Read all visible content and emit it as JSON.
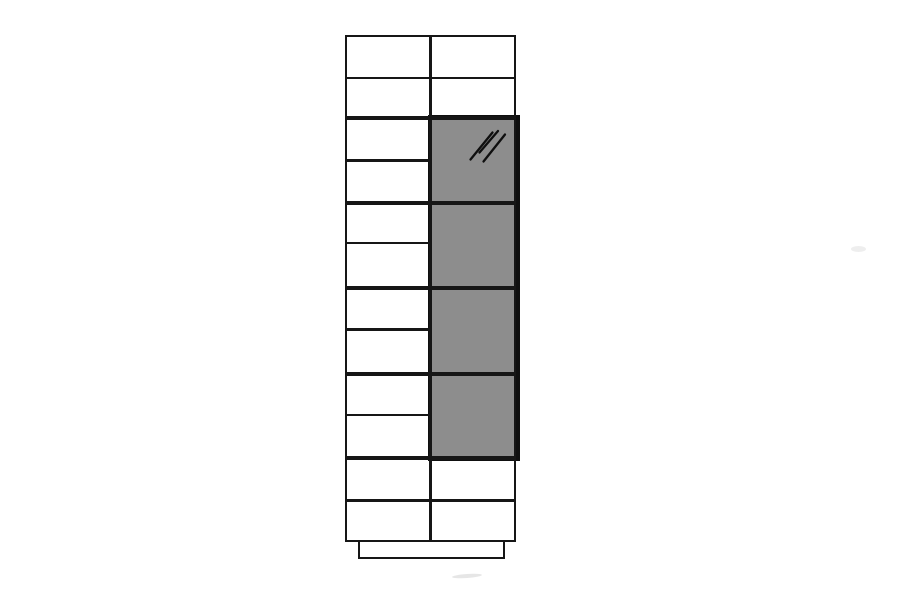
{
  "scene": {
    "width": 900,
    "height": 600,
    "background": "#ffffff",
    "kind": "furniture-technical-line-drawing"
  },
  "palette": {
    "line": "#161616",
    "glass_border": "#0f0f0f",
    "glass_fill": "#8d8d8d",
    "cabinet_fill": "#ffffff",
    "smudge": "#c8c8c8"
  },
  "cabinet": {
    "counts": {
      "left_drawer_rows": 12,
      "right_top_cells": 2,
      "glass_panes": 4,
      "right_bottom_cells": 2
    },
    "body": {
      "x": 345,
      "y": 35,
      "w": 171,
      "h": 507,
      "stroke": 2.6
    },
    "center_divider": {
      "x": 429.2,
      "y1": 35,
      "y2": 542,
      "w": 2.6
    },
    "h_lines": [
      {
        "y": 78,
        "x1": 345,
        "x2": 516,
        "w": 2.6,
        "kind": "thin-full"
      },
      {
        "y": 118,
        "x1": 345,
        "x2": 516,
        "w": 4,
        "kind": "thick-full"
      },
      {
        "y": 160.5,
        "x1": 345,
        "x2": 432,
        "w": 2.6,
        "kind": "thin-left"
      },
      {
        "y": 202.5,
        "x1": 345,
        "x2": 516,
        "w": 4,
        "kind": "thick-full"
      },
      {
        "y": 243,
        "x1": 345,
        "x2": 432,
        "w": 2.6,
        "kind": "thin-left"
      },
      {
        "y": 287.5,
        "x1": 345,
        "x2": 516,
        "w": 4,
        "kind": "thick-full"
      },
      {
        "y": 329.5,
        "x1": 345,
        "x2": 432,
        "w": 2.6,
        "kind": "thin-left"
      },
      {
        "y": 374,
        "x1": 345,
        "x2": 516,
        "w": 4,
        "kind": "thick-full"
      },
      {
        "y": 415,
        "x1": 345,
        "x2": 432,
        "w": 2.6,
        "kind": "thin-left"
      },
      {
        "y": 458,
        "x1": 345,
        "x2": 516,
        "w": 4,
        "kind": "thick-full"
      },
      {
        "y": 500.5,
        "x1": 345,
        "x2": 516,
        "w": 2.6,
        "kind": "thin-full"
      }
    ],
    "glass_panel": {
      "x": 428,
      "y": 115,
      "w": 92,
      "h": 346,
      "border": 4
    },
    "glass_hatch": {
      "stroke_width": 2.3,
      "lines": [
        [
          470.5,
          159.5,
          492.5,
          132.5
        ],
        [
          479.5,
          152.5,
          498,
          131
        ],
        [
          483.5,
          161.5,
          505,
          134.5
        ]
      ]
    },
    "plinth": {
      "x": 357.5,
      "y": 540,
      "w": 147,
      "h": 19,
      "stroke": 2.6
    }
  },
  "artifacts": [
    {
      "x": 452,
      "y": 574,
      "w": 30,
      "h": 4,
      "opacity": 0.45,
      "rotate": -4
    },
    {
      "x": 851,
      "y": 246,
      "w": 15,
      "h": 6,
      "opacity": 0.3,
      "rotate": 0
    }
  ]
}
